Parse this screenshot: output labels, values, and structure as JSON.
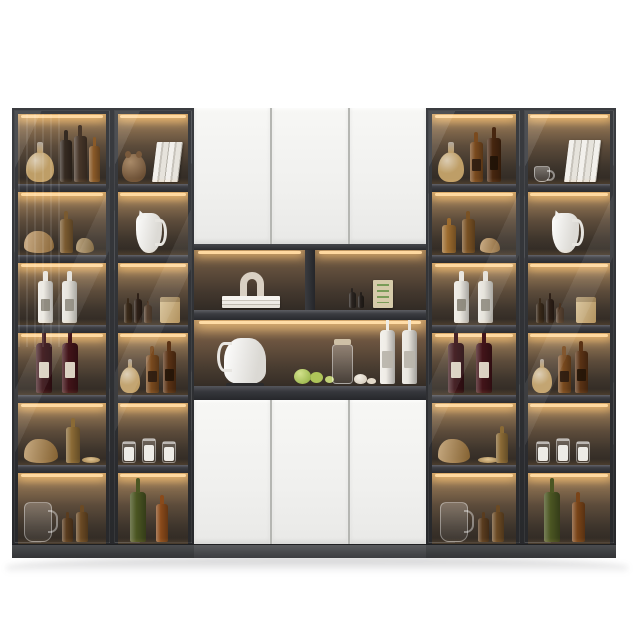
{
  "scene": {
    "subject": "modern-bar-display-wall-cabinet",
    "background": "#ffffff"
  },
  "palette": {
    "frame_dark": "#2c2e31",
    "door_white": "#f4f4f2",
    "door_seam": "#b5b6b2",
    "interior_glow_top": "#c59a63",
    "interior_dark_bottom": "#2e2823",
    "led_strip": "#ffd9a0",
    "shelf_board": "#3c3d42",
    "plinth": "#4a4c4f",
    "counter_board": "#36373c"
  },
  "cabinet": {
    "shelf_heights": [
      70,
      63,
      62,
      62,
      62,
      71
    ],
    "board_height": 8,
    "plinth_height": 13,
    "side_columns": [
      {
        "name": "left-outer-cabinet",
        "x": 12,
        "w": 100,
        "stripes": true,
        "shelves": [
          [
            {
              "n": "glass-decanter",
              "t": "decanter",
              "x": 8,
              "w": 28,
              "h": 30,
              "c": "#c9a76c"
            },
            {
              "n": "dark-liquor-bottle",
              "t": "bottle",
              "x": 42,
              "w": 12,
              "h": 42,
              "c": "#352a21"
            },
            {
              "n": "dark-liquor-bottle",
              "t": "bottle",
              "x": 56,
              "w": 13,
              "h": 46,
              "c": "#473629"
            },
            {
              "n": "amber-liquor-bottle",
              "t": "bottle",
              "x": 71,
              "w": 11,
              "h": 36,
              "c": "#8a5a28"
            }
          ],
          [
            {
              "n": "gold-glass-decor",
              "t": "lying",
              "x": 6,
              "w": 30,
              "h": 22,
              "c": "#b08348"
            },
            {
              "n": "amber-bottle",
              "t": "bottle",
              "x": 42,
              "w": 13,
              "h": 34,
              "c": "#7a5a30"
            },
            {
              "n": "gold-glass-decor",
              "t": "lying",
              "x": 58,
              "w": 18,
              "h": 15,
              "c": "#9c7b46"
            }
          ],
          [
            {
              "n": "white-ceramic-bottle",
              "t": "bottle",
              "x": 20,
              "w": 15,
              "h": 42,
              "c": "#eae7e0",
              "lbl": 1,
              "c2": "#8a857a"
            },
            {
              "n": "white-ceramic-bottle",
              "t": "bottle",
              "x": 44,
              "w": 15,
              "h": 42,
              "c": "#e4e1d9",
              "lbl": 1,
              "c2": "#8a857a"
            }
          ],
          [
            {
              "n": "red-wine-bottle",
              "t": "wine",
              "x": 18,
              "w": 16,
              "h": 50,
              "c": "#3a1217",
              "lbl": 1,
              "c2": "#e8e2d0"
            },
            {
              "n": "red-wine-bottle",
              "t": "wine",
              "x": 44,
              "w": 16,
              "h": 50,
              "c": "#421419",
              "lbl": 1,
              "c2": "#e8e2d0"
            }
          ],
          [
            {
              "n": "amber-glass-decor",
              "t": "lying",
              "x": 6,
              "w": 34,
              "h": 24,
              "c": "#a87c3e"
            },
            {
              "n": "amber-bottle",
              "t": "bottle",
              "x": 48,
              "w": 14,
              "h": 36,
              "c": "#8a6a35"
            },
            {
              "n": "gold-plate",
              "t": "plate",
              "x": 64,
              "w": 18,
              "h": 6
            }
          ],
          [
            {
              "n": "glass-pitcher",
              "t": "pitcher",
              "x": 6,
              "w": 28,
              "h": 40
            },
            {
              "n": "oil-bottle",
              "t": "bottle",
              "x": 44,
              "w": 11,
              "h": 24,
              "c": "#5a3c1e"
            },
            {
              "n": "oil-bottle",
              "t": "bottle",
              "x": 58,
              "w": 12,
              "h": 30,
              "c": "#6b4a24"
            }
          ]
        ]
      },
      {
        "name": "left-inner-cabinet",
        "x": 112,
        "w": 82,
        "stripes": false,
        "shelves": [
          [
            {
              "n": "bear-figurine",
              "t": "bear",
              "x": 4,
              "w": 24,
              "h": 28,
              "c": "#8a6a4a"
            },
            {
              "n": "white-books",
              "t": "books",
              "x": 34,
              "w": 26,
              "h": 40
            }
          ],
          [
            {
              "n": "white-jug",
              "t": "jug",
              "x": 18,
              "w": 26,
              "h": 40
            }
          ],
          [
            {
              "n": "condiment-bottle",
              "t": "bottle",
              "x": 6,
              "w": 8,
              "h": 20,
              "c": "#3a2a1a"
            },
            {
              "n": "condiment-bottle",
              "t": "bottle",
              "x": 16,
              "w": 8,
              "h": 24,
              "c": "#2e2017"
            },
            {
              "n": "condiment-bottle",
              "t": "bottle",
              "x": 26,
              "w": 8,
              "h": 18,
              "c": "#4a3320"
            },
            {
              "n": "kraft-paper-bag",
              "t": "bag",
              "x": 42,
              "w": 20,
              "h": 26,
              "c": "#c9ad7c"
            }
          ],
          [
            {
              "n": "glass-decanter",
              "t": "decanter",
              "x": 2,
              "w": 20,
              "h": 26,
              "c": "#c9a76c"
            },
            {
              "n": "whisky-bottle",
              "t": "bottle",
              "x": 28,
              "w": 13,
              "h": 38,
              "c": "#7a4a1e",
              "lbl": 1,
              "c2": "#2e1c10"
            },
            {
              "n": "whisky-bottle",
              "t": "bottle",
              "x": 45,
              "w": 13,
              "h": 42,
              "c": "#5a3214",
              "lbl": 1,
              "c2": "#241508"
            }
          ],
          [
            {
              "n": "candle-jar",
              "t": "jar",
              "x": 4,
              "w": 14,
              "h": 22
            },
            {
              "n": "candle-jar",
              "t": "jar",
              "x": 24,
              "w": 14,
              "h": 25
            },
            {
              "n": "candle-jar",
              "t": "jar",
              "x": 44,
              "w": 14,
              "h": 22
            }
          ],
          [
            {
              "n": "green-wine-bottle",
              "t": "wine",
              "x": 12,
              "w": 16,
              "h": 50,
              "c": "#4b5622"
            },
            {
              "n": "amber-bottle",
              "t": "bottle",
              "x": 38,
              "w": 12,
              "h": 38,
              "c": "#8a4a1a"
            }
          ]
        ]
      },
      {
        "name": "right-inner-cabinet",
        "x": 426,
        "w": 96,
        "stripes": false,
        "shelves": [
          [
            {
              "n": "glass-decanter",
              "t": "decanter",
              "x": 6,
              "w": 26,
              "h": 30,
              "c": "#c9a76c"
            },
            {
              "n": "whisky-bottle",
              "t": "bottle",
              "x": 38,
              "w": 13,
              "h": 40,
              "c": "#7a4a1e",
              "lbl": 1,
              "c2": "#2e1c10"
            },
            {
              "n": "whisky-bottle",
              "t": "bottle",
              "x": 55,
              "w": 14,
              "h": 44,
              "c": "#47260f",
              "lbl": 1,
              "c2": "#1f1206"
            }
          ],
          [
            {
              "n": "amber-bottle",
              "t": "bottle",
              "x": 10,
              "w": 14,
              "h": 28,
              "c": "#9c6b2e"
            },
            {
              "n": "amber-bottle",
              "t": "bottle",
              "x": 30,
              "w": 13,
              "h": 34,
              "c": "#7a5224"
            },
            {
              "n": "gold-glass-decor",
              "t": "lying",
              "x": 48,
              "w": 20,
              "h": 15,
              "c": "#b08348"
            }
          ],
          [
            {
              "n": "white-ceramic-bottle",
              "t": "bottle",
              "x": 22,
              "w": 15,
              "h": 42,
              "c": "#eae7e0",
              "lbl": 1,
              "c2": "#8a857a"
            },
            {
              "n": "white-ceramic-bottle",
              "t": "bottle",
              "x": 46,
              "w": 15,
              "h": 42,
              "c": "#e4e1d9",
              "lbl": 1,
              "c2": "#8a857a"
            }
          ],
          [
            {
              "n": "red-wine-bottle",
              "t": "wine",
              "x": 16,
              "w": 16,
              "h": 50,
              "c": "#3a1217",
              "lbl": 1,
              "c2": "#e8e2d0"
            },
            {
              "n": "red-wine-bottle",
              "t": "wine",
              "x": 44,
              "w": 16,
              "h": 50,
              "c": "#421419",
              "lbl": 1,
              "c2": "#e8e2d0"
            }
          ],
          [
            {
              "n": "amber-glass-decor",
              "t": "lying",
              "x": 6,
              "w": 32,
              "h": 24,
              "c": "#a87c3e"
            },
            {
              "n": "gold-plate",
              "t": "plate",
              "x": 46,
              "w": 20,
              "h": 6
            },
            {
              "n": "amber-bottle",
              "t": "bottle",
              "x": 64,
              "w": 12,
              "h": 30,
              "c": "#8a6a35"
            }
          ],
          [
            {
              "n": "glass-pitcher",
              "t": "pitcher",
              "x": 8,
              "w": 28,
              "h": 40
            },
            {
              "n": "oil-bottle",
              "t": "bottle",
              "x": 46,
              "w": 11,
              "h": 24,
              "c": "#5a3c1e"
            },
            {
              "n": "oil-bottle",
              "t": "bottle",
              "x": 60,
              "w": 12,
              "h": 30,
              "c": "#6b4a24"
            }
          ]
        ]
      },
      {
        "name": "right-outer-cabinet",
        "x": 522,
        "w": 94,
        "stripes": false,
        "shelves": [
          [
            {
              "n": "glass-teacup",
              "t": "cup",
              "x": 6,
              "w": 16,
              "h": 16
            },
            {
              "n": "white-books",
              "t": "books",
              "x": 36,
              "w": 32,
              "h": 42
            }
          ],
          [
            {
              "n": "white-jug",
              "t": "jug",
              "x": 24,
              "w": 27,
              "h": 40
            }
          ],
          [
            {
              "n": "condiment-bottle",
              "t": "bottle",
              "x": 8,
              "w": 8,
              "h": 20,
              "c": "#3a2a1a"
            },
            {
              "n": "condiment-bottle",
              "t": "bottle",
              "x": 18,
              "w": 8,
              "h": 24,
              "c": "#2e2017"
            },
            {
              "n": "condiment-bottle",
              "t": "bottle",
              "x": 28,
              "w": 8,
              "h": 16,
              "c": "#4a3320"
            },
            {
              "n": "kraft-paper-bag",
              "t": "bag",
              "x": 48,
              "w": 20,
              "h": 26,
              "c": "#c9ad7c"
            }
          ],
          [
            {
              "n": "glass-decanter",
              "t": "decanter",
              "x": 4,
              "w": 20,
              "h": 26,
              "c": "#c9a76c"
            },
            {
              "n": "whisky-bottle",
              "t": "bottle",
              "x": 30,
              "w": 13,
              "h": 38,
              "c": "#7a4a1e",
              "lbl": 1,
              "c2": "#2e1c10"
            },
            {
              "n": "whisky-bottle",
              "t": "bottle",
              "x": 47,
              "w": 13,
              "h": 42,
              "c": "#5a3214",
              "lbl": 1,
              "c2": "#241508"
            }
          ],
          [
            {
              "n": "candle-jar",
              "t": "jar",
              "x": 8,
              "w": 14,
              "h": 22
            },
            {
              "n": "candle-jar",
              "t": "jar",
              "x": 28,
              "w": 14,
              "h": 25
            },
            {
              "n": "candle-jar",
              "t": "jar",
              "x": 48,
              "w": 14,
              "h": 22
            }
          ],
          [
            {
              "n": "green-wine-bottle",
              "t": "wine",
              "x": 16,
              "w": 16,
              "h": 50,
              "c": "#4b5622"
            },
            {
              "n": "amber-bottle",
              "t": "bottle",
              "x": 44,
              "w": 13,
              "h": 40,
              "c": "#7a4418"
            }
          ]
        ]
      }
    ]
  },
  "center": {
    "top_door_count": 3,
    "bottom_door_count": 3,
    "cells": {
      "left": [
        {
          "n": "white-book-stack",
          "t": "bookstack",
          "x": 28,
          "w": 58,
          "h": 12
        },
        {
          "n": "arch-sculpture",
          "t": "arch",
          "x": 46,
          "w": 24,
          "h": 24,
          "c": "#d9d0c3",
          "b": 12
        }
      ],
      "right": [
        {
          "n": "small-dark-bottle",
          "t": "bottle",
          "x": 34,
          "w": 7,
          "h": 16,
          "c": "#2a2420"
        },
        {
          "n": "small-dark-bottle",
          "t": "bottle",
          "x": 43,
          "w": 6,
          "h": 13,
          "c": "#241f1b"
        },
        {
          "n": "green-print-card",
          "t": "card",
          "x": 58,
          "w": 20,
          "h": 28,
          "c": "#d6cbaa"
        }
      ]
    },
    "counter": [
      {
        "n": "white-electric-kettle",
        "t": "kettle",
        "x": 30,
        "w": 42,
        "h": 46
      },
      {
        "n": "green-apples",
        "t": "apples",
        "x": 100,
        "w": 17,
        "h": 15,
        "c": "#9ab944"
      },
      {
        "n": "glass-carafe",
        "t": "carafe",
        "x": 138,
        "w": 21,
        "h": 40
      },
      {
        "n": "garlic-bulbs",
        "t": "garlic",
        "x": 160,
        "w": 13,
        "h": 10
      },
      {
        "n": "white-wine-bottle",
        "t": "wine",
        "x": 186,
        "w": 15,
        "h": 54,
        "c": "#efece6",
        "lbl": 1,
        "c2": "#b9b4aa"
      },
      {
        "n": "white-wine-bottle",
        "t": "wine",
        "x": 208,
        "w": 15,
        "h": 54,
        "c": "#e9e6df",
        "lbl": 1,
        "c2": "#b9b4aa"
      }
    ]
  }
}
